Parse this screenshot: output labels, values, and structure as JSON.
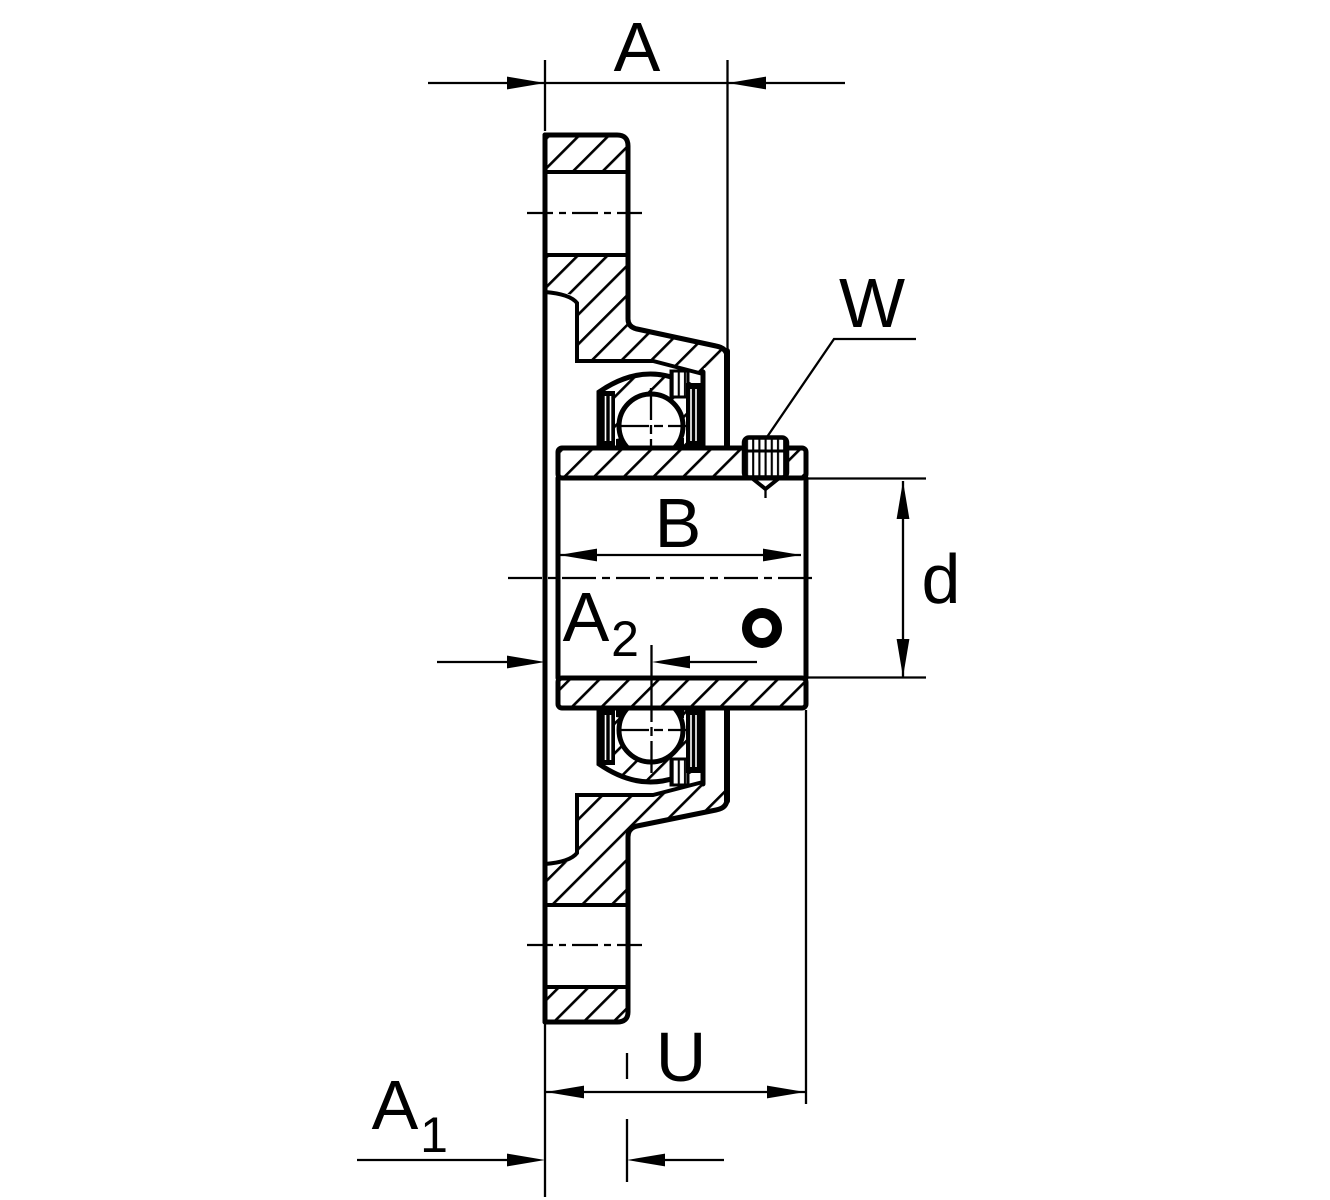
{
  "colors": {
    "line": "#000000",
    "background": "#ffffff"
  },
  "labels": {
    "a": "A",
    "w": "W",
    "b": "B",
    "d": "d",
    "a2_base": "A",
    "a2_sub": "2",
    "u": "U",
    "a1_base": "A",
    "a1_sub": "1"
  }
}
